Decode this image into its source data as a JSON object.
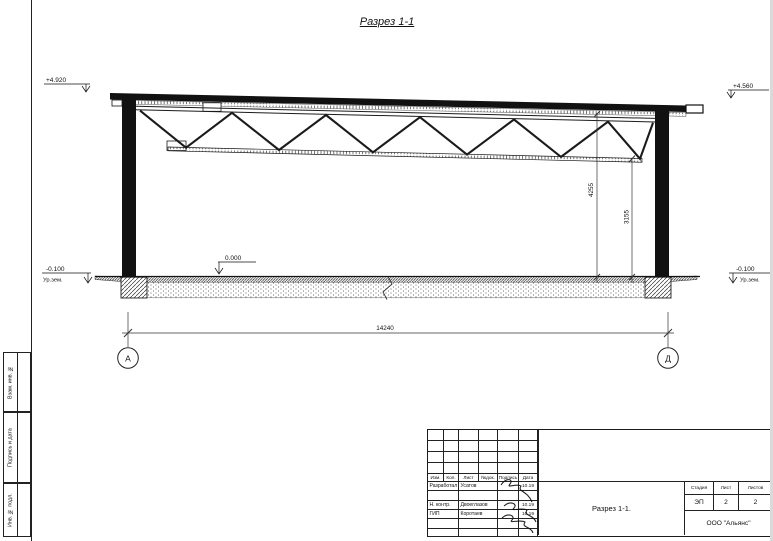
{
  "page": {
    "title": "Разрез 1-1"
  },
  "drawing": {
    "levels": {
      "roof_left": "+4.920",
      "roof_right": "+4.560",
      "floor": "0.000",
      "ground_left": "-0.100",
      "ground_left_label": "Ур.зем.",
      "ground_right": "-0.100",
      "ground_right_label": "Ур.зем."
    },
    "dims": {
      "span": "14240",
      "h_total": "4255",
      "h_clear": "3155"
    },
    "axes": {
      "left": "А",
      "right": "Д"
    }
  },
  "side_stamp": {
    "vzam": "Взам. инв. №",
    "podpis": "Подпись и дата",
    "inv": "Инв. № подл."
  },
  "title_block": {
    "rev_header": {
      "izm": "Изм.",
      "kol": "Кол.",
      "list": "Лист",
      "ndok": "№док.",
      "podpis": "Подпись",
      "data": "Дата"
    },
    "rows": [
      {
        "role": "Разработал",
        "name": "Усатов",
        "date": "10.19"
      },
      {
        "role": "",
        "name": "",
        "date": ""
      },
      {
        "role": "Н. контр.",
        "name": "Двоеглазов",
        "date": "10.19"
      },
      {
        "role": "ГИП",
        "name": "Коротаев",
        "date": "10.19"
      },
      {
        "role": "",
        "name": "",
        "date": ""
      },
      {
        "role": "",
        "name": "",
        "date": ""
      }
    ],
    "doc_title": "Разрез 1-1.",
    "company": "ООО \"Альянс\"",
    "stage": {
      "label": "Стадия",
      "value": "ЭП"
    },
    "sheet": {
      "label": "Лист",
      "value": "2"
    },
    "sheets": {
      "label": "Листов",
      "value": "2"
    }
  }
}
